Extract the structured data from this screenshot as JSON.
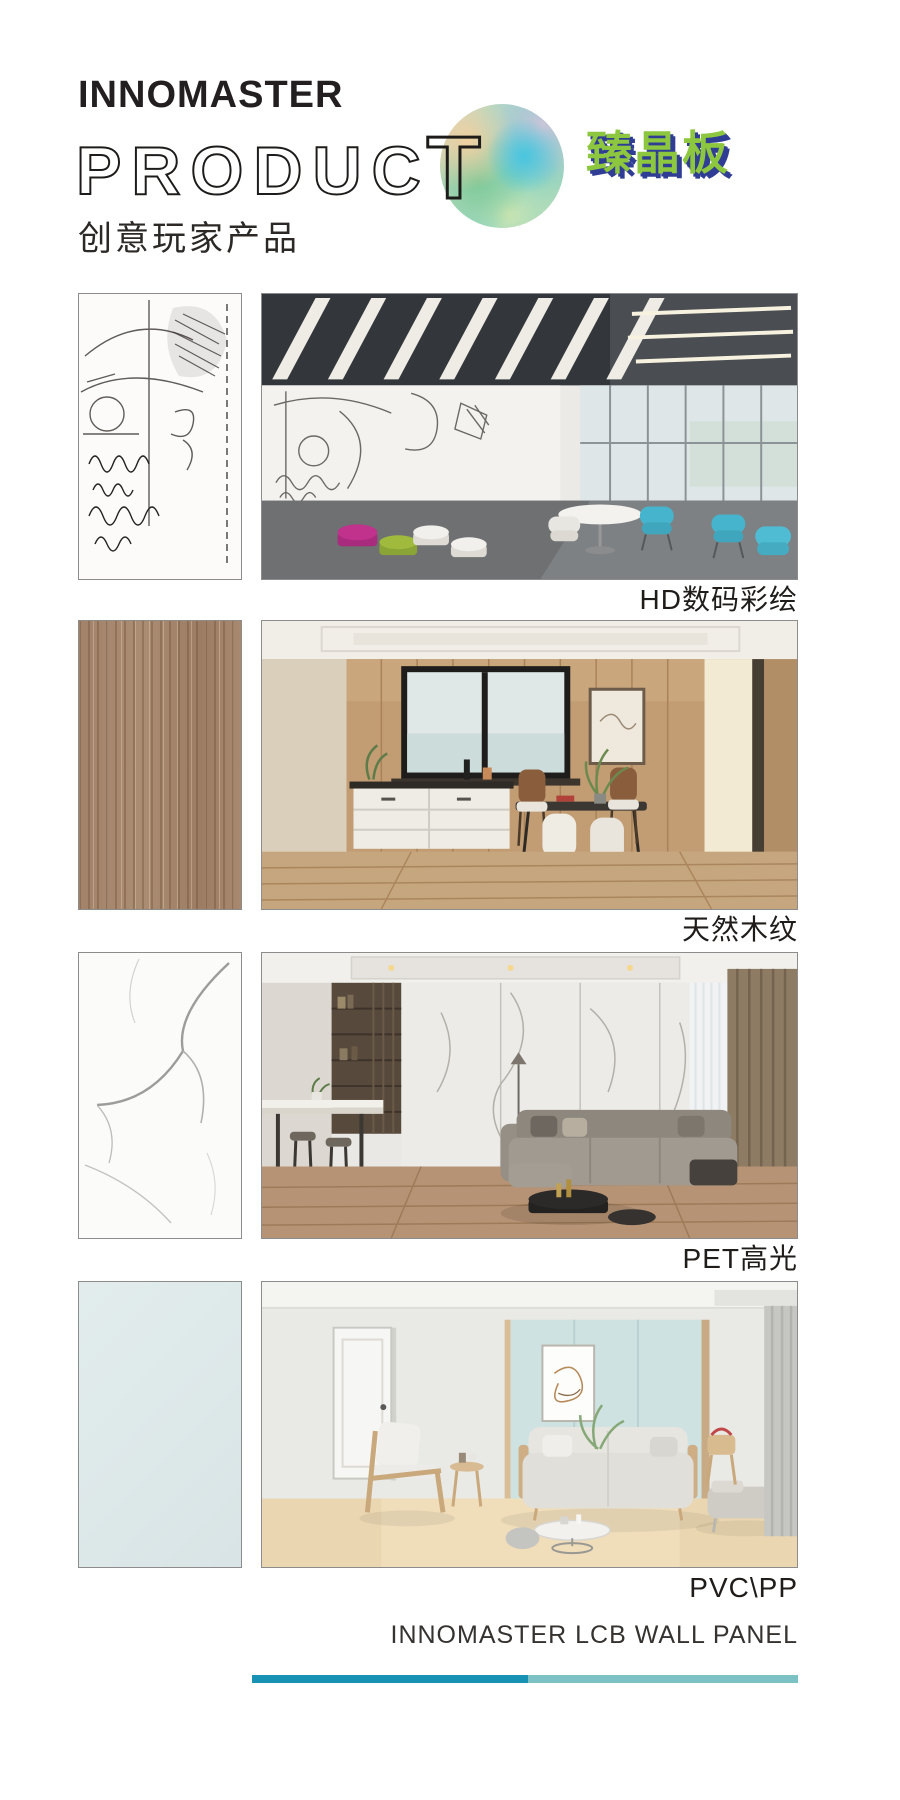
{
  "header": {
    "brand": "INNOMASTER",
    "product_outline": "PRODUC",
    "product_t": "T",
    "logo_cn": "臻晶板",
    "subtitle": "创意玩家产品"
  },
  "sections": [
    {
      "caption": "HD数码彩绘",
      "swatch": "hd-digital-sketch-print",
      "scene": "office-with-printed-wall-panels"
    },
    {
      "caption": "天然木纹",
      "swatch": "natural-wood-grain",
      "scene": "dining-room-wood-panel-wall"
    },
    {
      "caption": "PET高光",
      "swatch": "white-marble-gloss",
      "scene": "living-room-marble-panel-wall"
    },
    {
      "caption": "PVC\\PP",
      "swatch": "plain-pale-blue",
      "scene": "living-room-pale-blue-panel-wall"
    }
  ],
  "footer": {
    "title": "INNOMASTER LCB WALL PANEL"
  },
  "colors": {
    "logo_green": "#8dc63f",
    "logo_blue": "#303d94",
    "line_left": "#1792b4",
    "line_right": "#7cc2c5"
  }
}
